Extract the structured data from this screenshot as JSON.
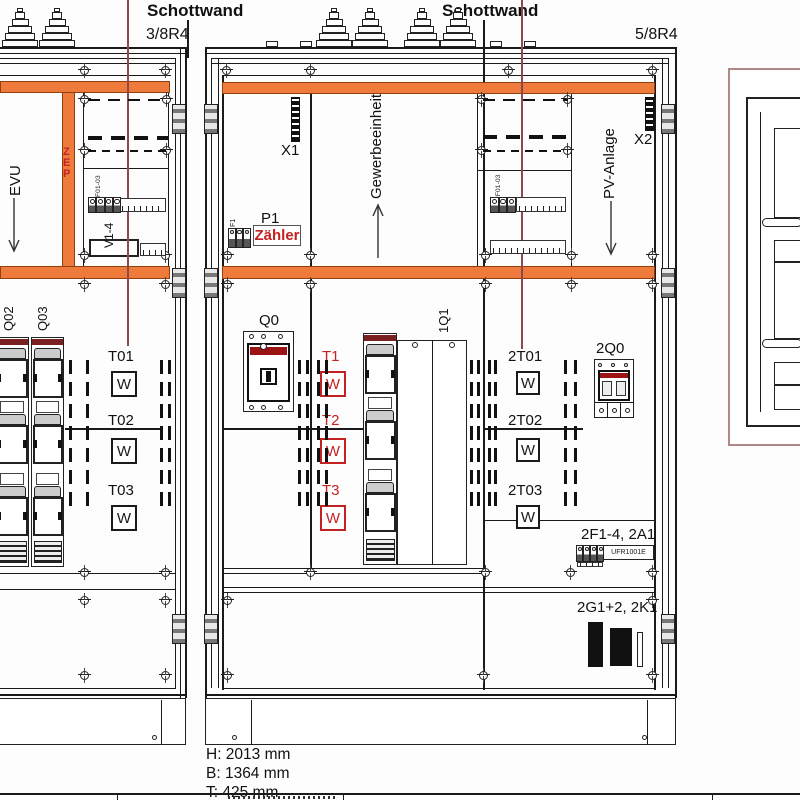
{
  "drawing": {
    "schottwand_left": "Schottwand",
    "schottwand_right": "Schottwand",
    "rack_left": "3/8R4",
    "rack_right": "5/8R4"
  },
  "left_cabinet": {
    "feed_label": "EVU",
    "zep": "ZEP",
    "subpanel_small_label": "F01-03",
    "subpanel_label": "V1-4",
    "strip1_label": "Q02",
    "strip2_label": "Q03",
    "meter_rows": [
      {
        "label": "T01",
        "w": "W"
      },
      {
        "label": "T02",
        "w": "W"
      },
      {
        "label": "T03",
        "w": "W"
      }
    ]
  },
  "middle_cabinet": {
    "terminal_left": "X1",
    "terminal_right": "X2",
    "aux_fuse": "F1",
    "meter_id": "P1",
    "meter_name": "Zähler",
    "zone_left": "Gewerbeeinheit",
    "zone_right": "PV-Anlage",
    "main_breaker": "Q0",
    "fuse_switch": "1Q1",
    "pv_subpanel_small_label": "2F01-03",
    "meter_rows_left": [
      {
        "label": "T1",
        "w": "W"
      },
      {
        "label": "T2",
        "w": "W"
      },
      {
        "label": "T3",
        "w": "W"
      }
    ],
    "meter_rows_right": [
      {
        "label": "2T01",
        "w": "W"
      },
      {
        "label": "2T02",
        "w": "W"
      },
      {
        "label": "2T03",
        "w": "W"
      }
    ],
    "pv_breaker": "2Q0",
    "relay_group_label": "2F1-4, 2A1",
    "relay_device": "UFR1001E",
    "contactor_group_label": "2G1+2, 2K1"
  },
  "dimensions": {
    "height": "H: 2013 mm",
    "width": "B: 1364 mm",
    "depth": "T: 425 mm"
  },
  "colors": {
    "busbar_orange": "#ee7b3c",
    "accent_red": "#c42222",
    "guide_maroon": "#8e4a4a"
  }
}
